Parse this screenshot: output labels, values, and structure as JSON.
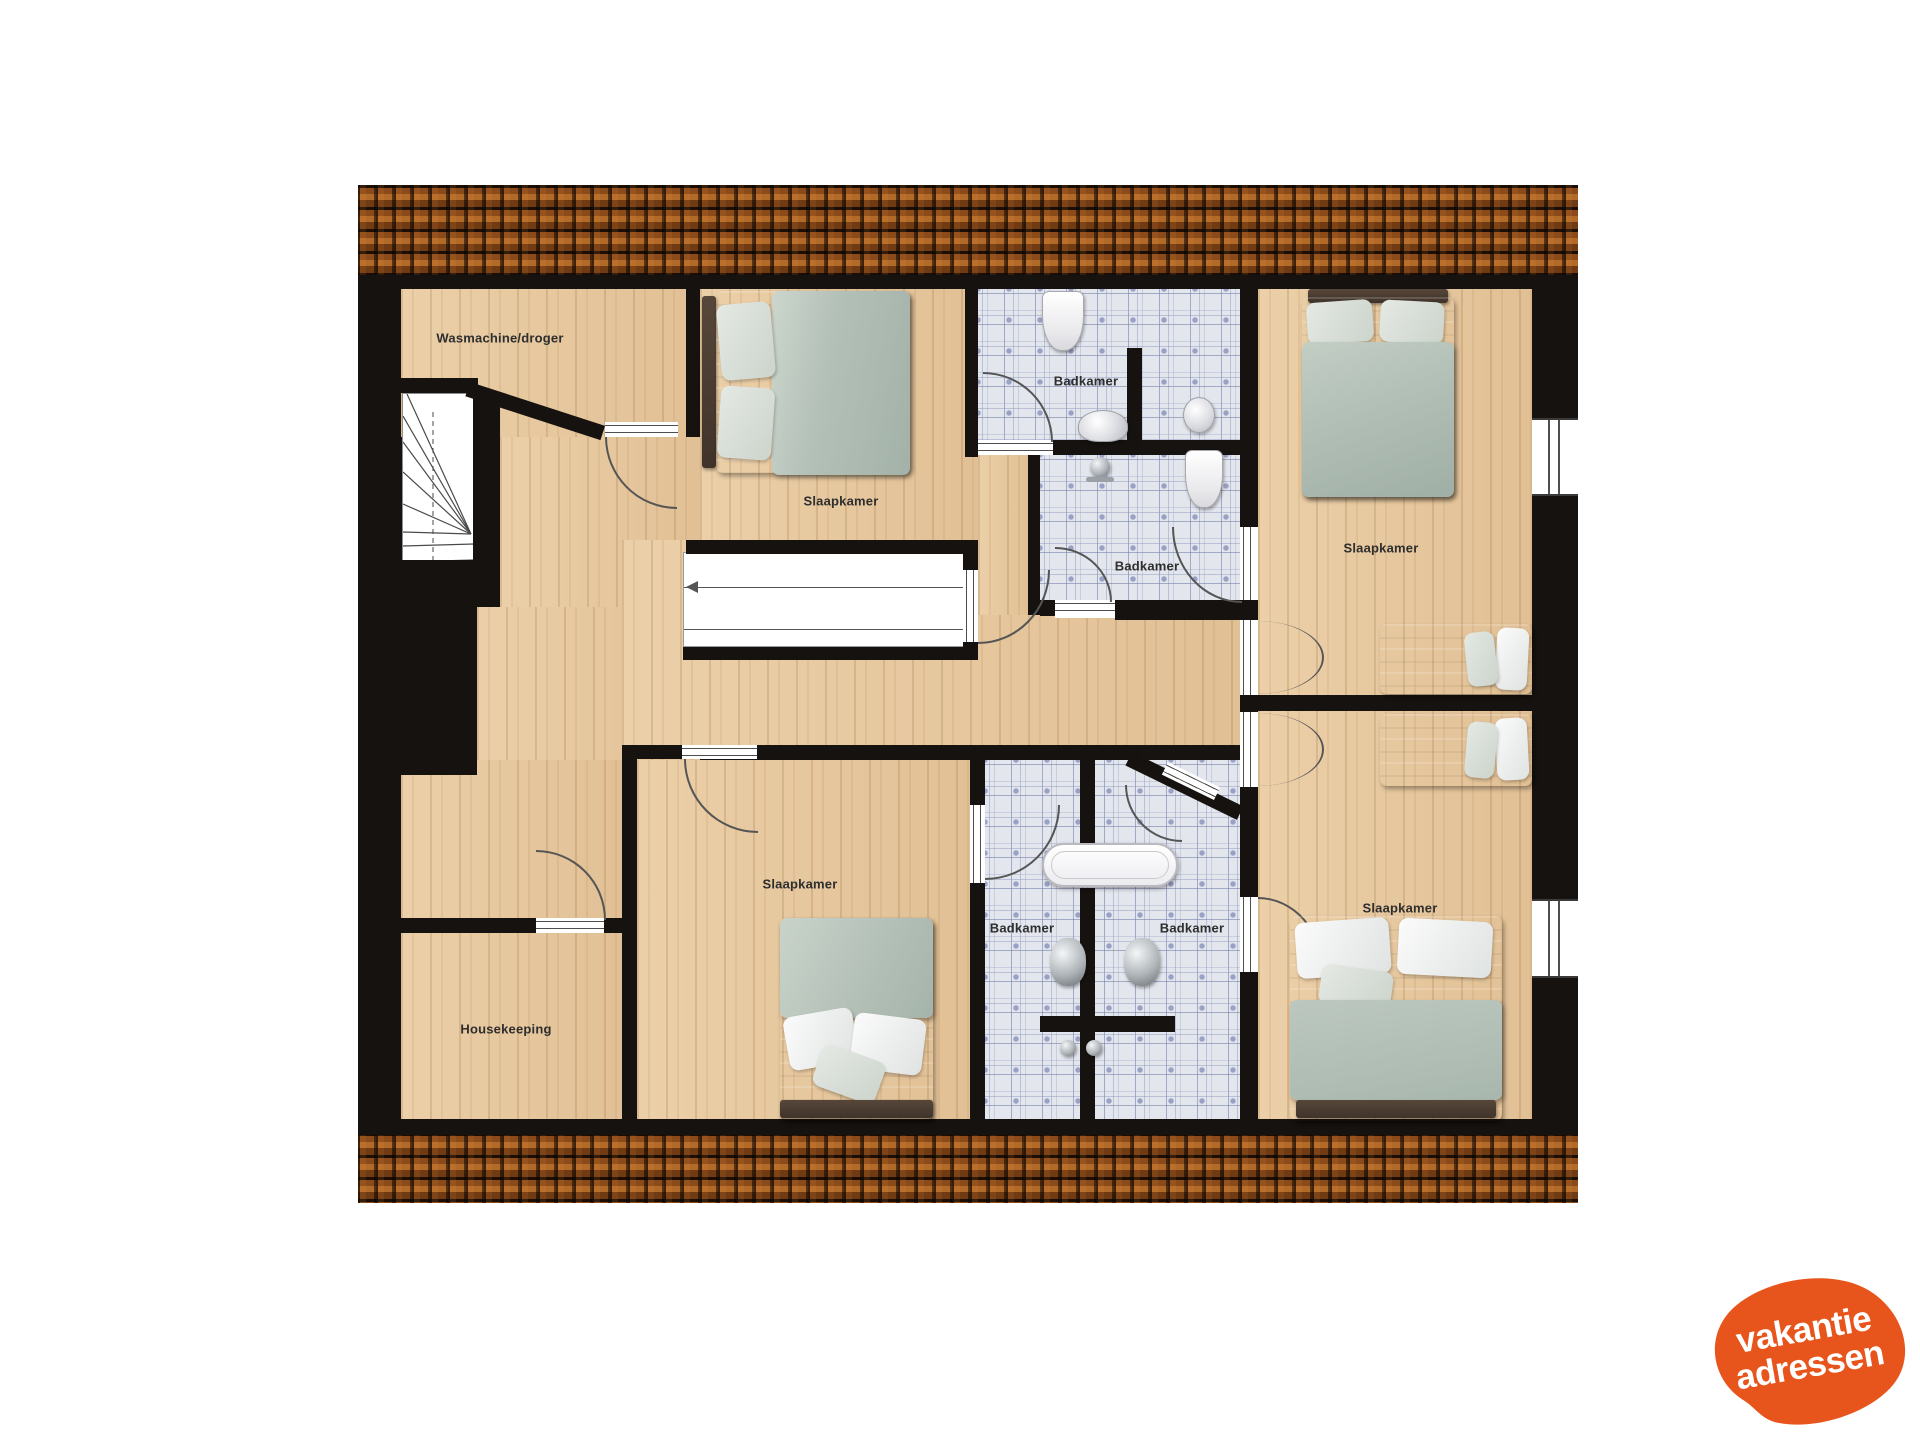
{
  "plan_title": "Verdieping plattegrond (vakantiehuis)",
  "palette": {
    "wall": "#15120f",
    "wood_floor": "#e6c79e",
    "bathroom_tile": "#e4e6ee",
    "roof_tile_light": "#b26a28",
    "roof_tile_dark": "#1c0e05",
    "bed_duvet_sage": "#b5c2b9",
    "bed_duvet_gray": "#99a098",
    "headboard_brown": "#4a3b2e",
    "logo_orange": "#e8551c"
  },
  "rooms": {
    "laundry": {
      "label": "Wasmachine/droger"
    },
    "bedroom_top_middle": {
      "label": "Slaapkamer"
    },
    "bathroom_top": {
      "label": "Badkamer"
    },
    "bathroom_middle": {
      "label": "Badkamer"
    },
    "bedroom_top_right": {
      "label": "Slaapkamer"
    },
    "bedroom_center": {
      "label": "Slaapkamer"
    },
    "bathroom_bottom_left": {
      "label": "Badkamer"
    },
    "bathroom_bottom_right": {
      "label": "Badkamer"
    },
    "bedroom_bottom_right": {
      "label": "Slaapkamer"
    },
    "housekeeping": {
      "label": "Housekeeping"
    }
  },
  "logo": {
    "line1": "vakantie",
    "line2": "adressen",
    "background": "#e8551c",
    "text_color": "#ffffff"
  }
}
